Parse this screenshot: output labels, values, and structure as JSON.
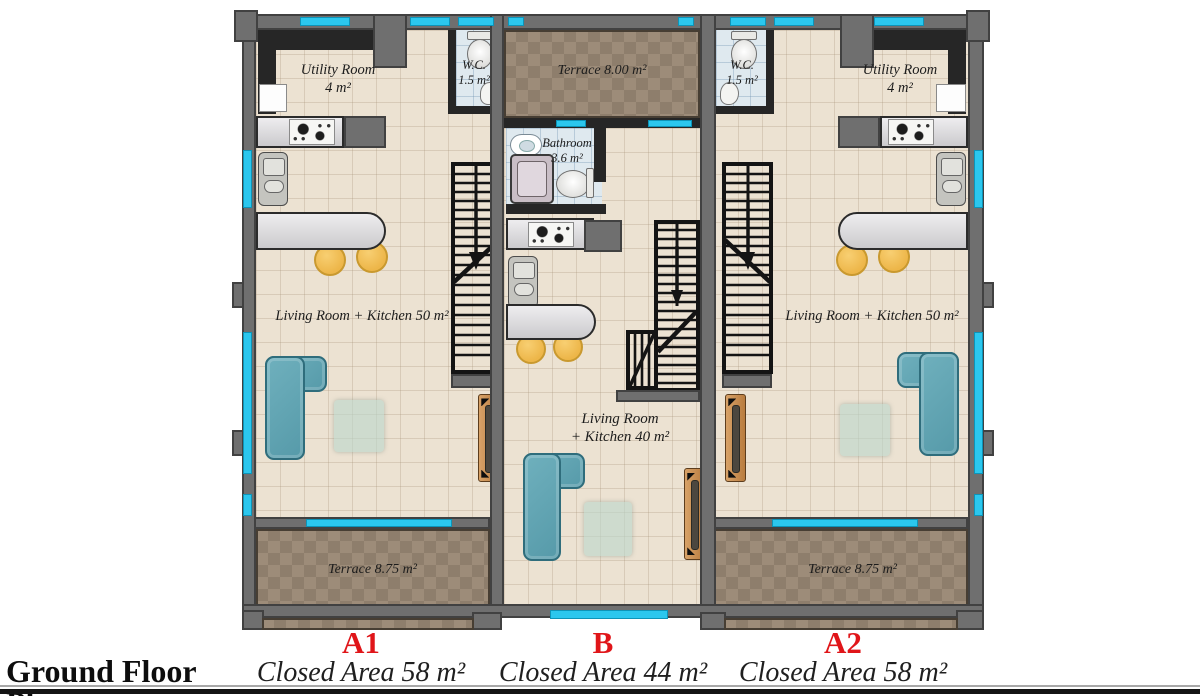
{
  "page": {
    "title": "Ground Floor Plan"
  },
  "legend": {
    "units": [
      {
        "id": "A1",
        "closed_area": "Closed Area 58 m²"
      },
      {
        "id": "B",
        "closed_area": "Closed Area 44 m²"
      },
      {
        "id": "A2",
        "closed_area": "Closed Area 58 m²"
      }
    ]
  },
  "unit_a1": {
    "utility_room": {
      "name": "Utility Room",
      "area": "4 m²"
    },
    "wc": {
      "name": "W.C.",
      "area": "1.5 m²"
    },
    "living": {
      "label": "Living Room + Kitchen 50 m²"
    },
    "terrace": {
      "label": "Terrace 8.75 m²"
    }
  },
  "unit_b": {
    "terrace": {
      "label": "Terrace 8.00 m²"
    },
    "bathroom": {
      "name": "Bathroom",
      "area": "3.6 m²"
    },
    "living": {
      "line1": "Living Room",
      "line2": "+ Kitchen 40 m²"
    }
  },
  "unit_a2": {
    "wc": {
      "name": "W.C.",
      "area": "1.5 m²"
    },
    "utility_room": {
      "name": "Utility Room",
      "area": "4 m²"
    },
    "living": {
      "label": "Living Room + Kitchen 50 m²"
    },
    "terrace": {
      "label": "Terrace 8.75 m²"
    }
  },
  "colors": {
    "window": "#2bc7ee",
    "wall": "#6f6f6f",
    "inner_wall": "#262626",
    "floor_tile": "#ece2d2",
    "terrace_tile": "#9d8c79",
    "bath_tile": "#dfe9ef",
    "sofa": "#5fa5b4",
    "stool": "#edb649",
    "door_wood": "#c6874e",
    "unit_label": "#e01519"
  },
  "fixtures": {
    "stairs": "tread-lines-with-down-arrow",
    "stove": "four-burner-cooktop",
    "sink": "grey-basin-unit",
    "toilet": "bowl-and-tank",
    "bathtub": "rounded-tub",
    "sofa": "l-shaped-sofa",
    "stool": "round-stool",
    "door": "wood-leaf",
    "rug": "square-rug",
    "window": "cyan-strip"
  }
}
